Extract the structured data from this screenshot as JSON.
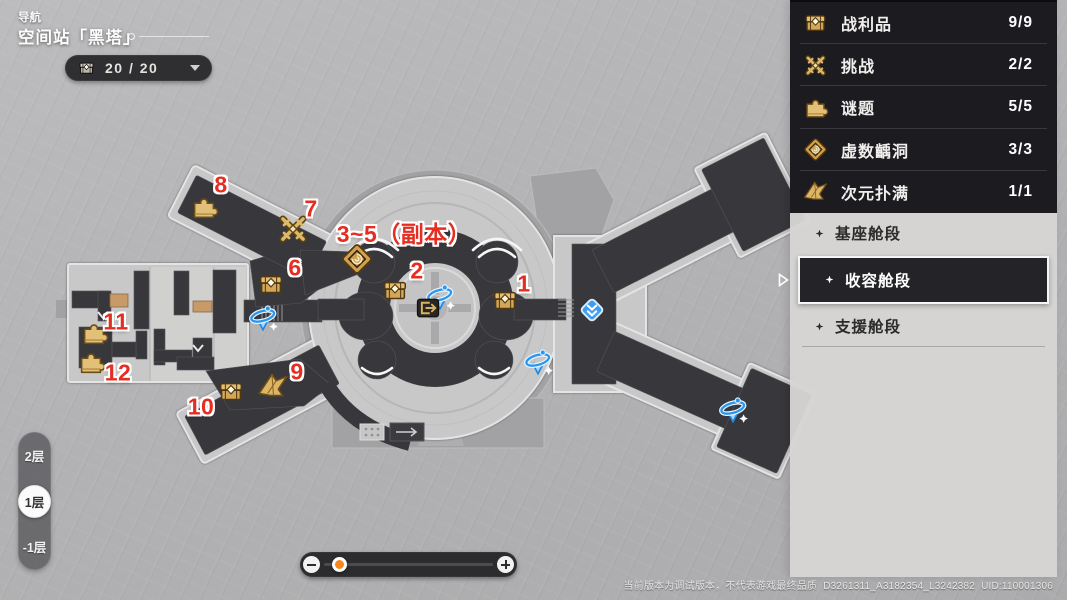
{
  "header": {
    "breadcrumb": "导航",
    "title": "空间站「黑塔」"
  },
  "chest_counter": {
    "icon": "chest-icon",
    "value": "20 / 20"
  },
  "legend_panel": {
    "stats": [
      {
        "icon": "chest",
        "label": "战利品",
        "value": "9/9"
      },
      {
        "icon": "swords",
        "label": "挑战",
        "value": "2/2"
      },
      {
        "icon": "puzzle",
        "label": "谜题",
        "value": "5/5"
      },
      {
        "icon": "rift",
        "label": "虚数齲洞",
        "value": "3/3"
      },
      {
        "icon": "bird",
        "label": "次元扑满",
        "value": "1/1"
      }
    ],
    "regions": [
      {
        "label": "基座舱段",
        "selected": false
      },
      {
        "label": "收容舱段",
        "selected": true
      },
      {
        "label": "支援舱段",
        "selected": false
      }
    ]
  },
  "floor_selector": {
    "floors": [
      {
        "label": "2层",
        "selected": false
      },
      {
        "label": "1层",
        "selected": true
      },
      {
        "label": "-1层",
        "selected": false
      }
    ]
  },
  "zoom_slider": {
    "fraction": 0.05
  },
  "footer": {
    "disclaimer": "当前版本为调试版本，不代表游戏最终品质",
    "build": "D3261311_A3182354_L3242382",
    "uid": "UID:110001306"
  },
  "map": {
    "markers": [
      {
        "num": "1",
        "nx": 524,
        "ny": 284,
        "icon": "chest",
        "ix": 505,
        "iy": 301
      },
      {
        "num": "2",
        "nx": 417,
        "ny": 271,
        "icon": "chest",
        "ix": 395,
        "iy": 291
      },
      {
        "num": "3~5（副本）",
        "nx": 404,
        "ny": 232,
        "icon": "rift",
        "ix": 357,
        "iy": 259
      },
      {
        "num": "6",
        "nx": 295,
        "ny": 268,
        "icon": "chest",
        "ix": 271,
        "iy": 285
      },
      {
        "num": "7",
        "nx": 311,
        "ny": 209,
        "icon": "swords",
        "ix": 293,
        "iy": 229
      },
      {
        "num": "8",
        "nx": 221,
        "ny": 185,
        "icon": "puzzle",
        "ix": 204,
        "iy": 207
      },
      {
        "num": "9",
        "nx": 297,
        "ny": 372,
        "icon": "bird",
        "ix": 273,
        "iy": 386
      },
      {
        "num": "10",
        "nx": 201,
        "ny": 407,
        "icon": "chest",
        "ix": 231,
        "iy": 392
      },
      {
        "num": "11",
        "nx": 116,
        "ny": 322,
        "icon": "puzzle",
        "ix": 94,
        "iy": 333
      },
      {
        "num": "12",
        "nx": 118,
        "ny": 373,
        "icon": "puzzle",
        "ix": 91,
        "iy": 362
      }
    ],
    "poi": [
      {
        "type": "gyro",
        "x": 440,
        "y": 296
      },
      {
        "type": "gyro",
        "x": 263,
        "y": 317
      },
      {
        "type": "gyro",
        "x": 538,
        "y": 361
      },
      {
        "type": "gyro",
        "x": 733,
        "y": 409
      },
      {
        "type": "teleport",
        "x": 592,
        "y": 310
      },
      {
        "type": "elevator",
        "x": 428,
        "y": 308
      }
    ]
  },
  "colors": {
    "marker_red": "#e52d22",
    "gold": "#d7ad62",
    "anchor_blue": "#2a97ef",
    "panel_dark": "#1c1b1f",
    "panel_light": "#d6d5d3",
    "corridor_dark": "#38383c"
  }
}
